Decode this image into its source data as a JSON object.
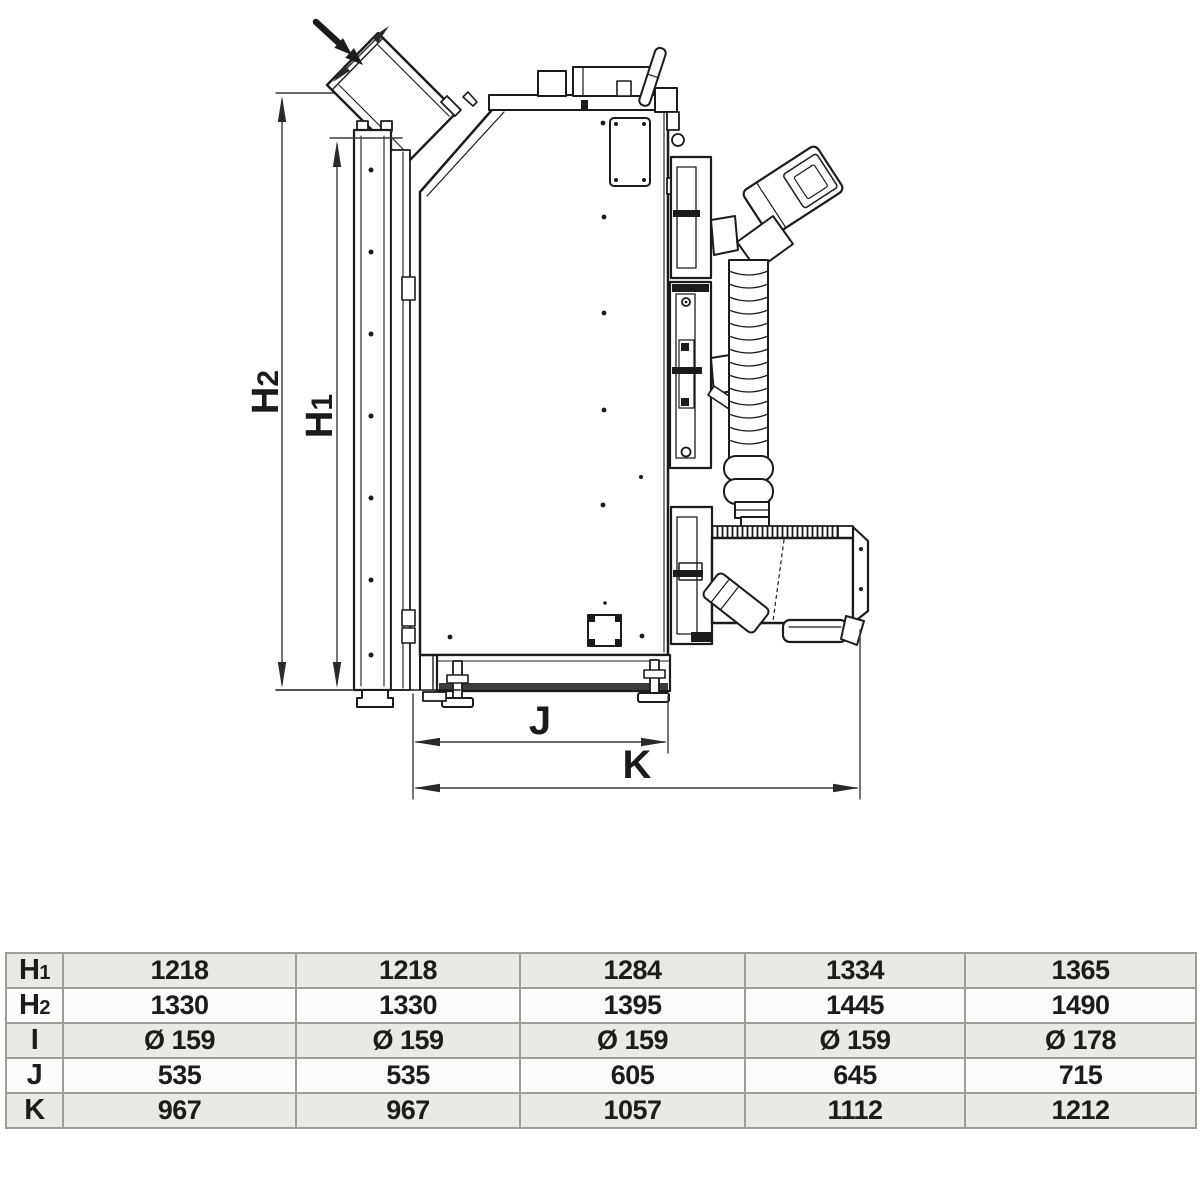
{
  "drawing": {
    "dimension_labels": {
      "h1": {
        "main": "H",
        "sub": "1"
      },
      "h2": {
        "main": "H",
        "sub": "2"
      },
      "j": "J",
      "k": "K"
    }
  },
  "table": {
    "rows": [
      {
        "label": "H",
        "label_sub": "1",
        "values": [
          "1218",
          "1218",
          "1284",
          "1334",
          "1365"
        ]
      },
      {
        "label": "H",
        "label_sub": "2",
        "values": [
          "1330",
          "1330",
          "1395",
          "1445",
          "1490"
        ]
      },
      {
        "label": "I",
        "label_sub": "",
        "values": [
          "Ø 159",
          "Ø 159",
          "Ø 159",
          "Ø 159",
          "Ø 178"
        ]
      },
      {
        "label": "J",
        "label_sub": "",
        "values": [
          "535",
          "535",
          "605",
          "645",
          "715"
        ]
      },
      {
        "label": "K",
        "label_sub": "",
        "values": [
          "967",
          "967",
          "1057",
          "1112",
          "1212"
        ]
      }
    ]
  },
  "colors": {
    "line": "#1b1b1b",
    "dimension": "#3a3a3a",
    "table_border": "#9d9d99",
    "row_shaded": "#e9e9e5",
    "row_plain": "#fcfcfa",
    "background": "#ffffff"
  }
}
